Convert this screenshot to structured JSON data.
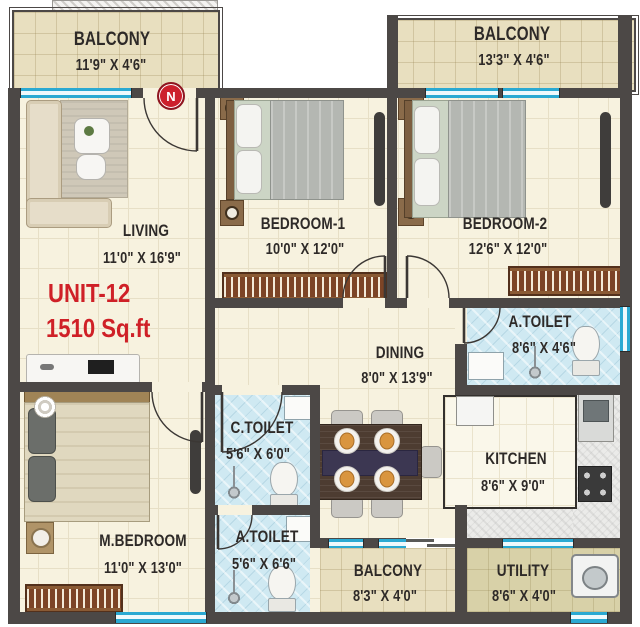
{
  "plan": {
    "unit": {
      "id": "UNIT-12",
      "area": "1510 Sq.ft"
    },
    "compass": {
      "label": "N"
    },
    "rooms": {
      "balcony_top_left": {
        "name": "BALCONY",
        "dims": "11'9\" X 4'6\""
      },
      "balcony_top_right": {
        "name": "BALCONY",
        "dims": "13'3\" X 4'6\""
      },
      "living": {
        "name": "LIVING",
        "dims": "11'0\" X 16'9\""
      },
      "bedroom1": {
        "name": "BEDROOM-1",
        "dims": "10'0\" X 12'0\""
      },
      "bedroom2": {
        "name": "BEDROOM-2",
        "dims": "12'6\" X 12'0\""
      },
      "attached_toilet_bedroom2": {
        "name": "A.TOILET",
        "dims": "8'6\" X 4'6\""
      },
      "dining": {
        "name": "DINING",
        "dims": "8'0\" X 13'9\""
      },
      "common_toilet": {
        "name": "C.TOILET",
        "dims": "5'6\" X 6'0\""
      },
      "kitchen": {
        "name": "KITCHEN",
        "dims": "8'6\" X 9'0\""
      },
      "master_bedroom": {
        "name": "M.BEDROOM",
        "dims": "11'0\" X 13'0\""
      },
      "attached_toilet_master": {
        "name": "A.TOILET",
        "dims": "5'6\" X 6'6\""
      },
      "balcony_bottom": {
        "name": "BALCONY",
        "dims": "8'3\" X 4'0\""
      },
      "utility": {
        "name": "UTILITY",
        "dims": "8'6\" X 4'0\""
      }
    },
    "theme": {
      "wall": "#4c4846",
      "floor": "#f7f2df",
      "balcony": "#e8dfbf",
      "toilet": "#cfe9f2",
      "utility": "#d8d1a8",
      "window": "#2aa9d2",
      "accent": "#cf2027",
      "text": "#2e2a28",
      "marble": "#ebebe9"
    }
  }
}
